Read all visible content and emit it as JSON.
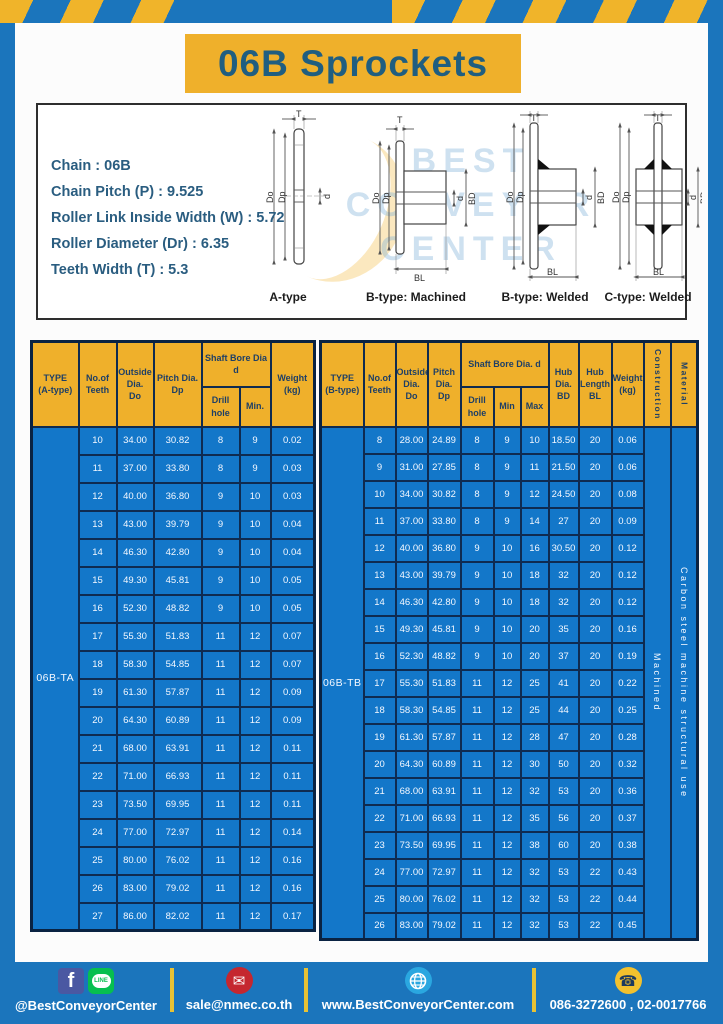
{
  "page": {
    "title": "06B Sprockets"
  },
  "colors": {
    "frame_blue": "#1b75bc",
    "accent_yellow": "#efb02b",
    "table_cell_blue": "#1377c9",
    "grid_navy": "#0f2b50",
    "title_text": "#205e80"
  },
  "specs": {
    "lines": [
      "Chain  : 06B",
      "Chain Pitch (P)  :  9.525",
      "Roller Link Inside Width (W)  :  5.72",
      "Roller Diameter (Dr)  : 6.35",
      "Teeth Width (T)  :  5.3"
    ]
  },
  "diagrams": {
    "captions": [
      "A-type",
      "B-type: Machined",
      "B-type: Welded",
      "C-type: Welded"
    ],
    "dim_labels": {
      "t": "T",
      "do": "Do",
      "dp": "Dp",
      "d": "d",
      "bd": "BD",
      "bl": "BL"
    },
    "watermark_lines": [
      "BEST",
      "CONVEYOR",
      "CENTER"
    ]
  },
  "table_a": {
    "type_label": "06B-TA",
    "headers": {
      "type": "TYPE\n(A-type)",
      "teeth": "No.of\nTeeth",
      "outside": "Outside\nDia.\nDo",
      "pitch": "Pitch Dia.\nDp",
      "shaft_bore": "Shaft Bore Dia d",
      "drill_hole": "Drill hole",
      "min": "Min.",
      "weight": "Weight\n(kg)"
    },
    "rows": [
      [
        "10",
        "34.00",
        "30.82",
        "8",
        "9",
        "0.02"
      ],
      [
        "11",
        "37.00",
        "33.80",
        "8",
        "9",
        "0.03"
      ],
      [
        "12",
        "40.00",
        "36.80",
        "9",
        "10",
        "0.03"
      ],
      [
        "13",
        "43.00",
        "39.79",
        "9",
        "10",
        "0.04"
      ],
      [
        "14",
        "46.30",
        "42.80",
        "9",
        "10",
        "0.04"
      ],
      [
        "15",
        "49.30",
        "45.81",
        "9",
        "10",
        "0.05"
      ],
      [
        "16",
        "52.30",
        "48.82",
        "9",
        "10",
        "0.05"
      ],
      [
        "17",
        "55.30",
        "51.83",
        "11",
        "12",
        "0.07"
      ],
      [
        "18",
        "58.30",
        "54.85",
        "11",
        "12",
        "0.07"
      ],
      [
        "19",
        "61.30",
        "57.87",
        "11",
        "12",
        "0.09"
      ],
      [
        "20",
        "64.30",
        "60.89",
        "11",
        "12",
        "0.09"
      ],
      [
        "21",
        "68.00",
        "63.91",
        "11",
        "12",
        "0.11"
      ],
      [
        "22",
        "71.00",
        "66.93",
        "11",
        "12",
        "0.11"
      ],
      [
        "23",
        "73.50",
        "69.95",
        "11",
        "12",
        "0.11"
      ],
      [
        "24",
        "77.00",
        "72.97",
        "11",
        "12",
        "0.14"
      ],
      [
        "25",
        "80.00",
        "76.02",
        "11",
        "12",
        "0.16"
      ],
      [
        "26",
        "83.00",
        "79.02",
        "11",
        "12",
        "0.16"
      ],
      [
        "27",
        "86.00",
        "82.02",
        "11",
        "12",
        "0.17"
      ]
    ]
  },
  "table_b": {
    "type_label": "06B-TB",
    "construction": "Machined",
    "material": "Carbon steel machine structural use",
    "headers": {
      "type": "TYPE\n(B-type)",
      "teeth": "No.of\nTeeth",
      "outside": "Outside\nDia.\nDo",
      "pitch": "Pitch\nDia.\nDp",
      "shaft_bore": "Shaft Bore Dia. d",
      "drill_hole": "Drill hole",
      "min": "Min",
      "max": "Max",
      "hub_dia": "Hub\nDia.\nBD",
      "hub_length": "Hub\nLength\nBL",
      "weight": "Weight\n(kg)",
      "construction": "Construction",
      "material": "Material"
    },
    "rows": [
      [
        "8",
        "28.00",
        "24.89",
        "8",
        "9",
        "10",
        "18.50",
        "20",
        "0.06"
      ],
      [
        "9",
        "31.00",
        "27.85",
        "8",
        "9",
        "11",
        "21.50",
        "20",
        "0.06"
      ],
      [
        "10",
        "34.00",
        "30.82",
        "8",
        "9",
        "12",
        "24.50",
        "20",
        "0.08"
      ],
      [
        "11",
        "37.00",
        "33.80",
        "8",
        "9",
        "14",
        "27",
        "20",
        "0.09"
      ],
      [
        "12",
        "40.00",
        "36.80",
        "9",
        "10",
        "16",
        "30.50",
        "20",
        "0.12"
      ],
      [
        "13",
        "43.00",
        "39.79",
        "9",
        "10",
        "18",
        "32",
        "20",
        "0.12"
      ],
      [
        "14",
        "46.30",
        "42.80",
        "9",
        "10",
        "18",
        "32",
        "20",
        "0.12"
      ],
      [
        "15",
        "49.30",
        "45.81",
        "9",
        "10",
        "20",
        "35",
        "20",
        "0.16"
      ],
      [
        "16",
        "52.30",
        "48.82",
        "9",
        "10",
        "20",
        "37",
        "20",
        "0.19"
      ],
      [
        "17",
        "55.30",
        "51.83",
        "11",
        "12",
        "25",
        "41",
        "20",
        "0.22"
      ],
      [
        "18",
        "58.30",
        "54.85",
        "11",
        "12",
        "25",
        "44",
        "20",
        "0.25"
      ],
      [
        "19",
        "61.30",
        "57.87",
        "11",
        "12",
        "28",
        "47",
        "20",
        "0.28"
      ],
      [
        "20",
        "64.30",
        "60.89",
        "11",
        "12",
        "30",
        "50",
        "20",
        "0.32"
      ],
      [
        "21",
        "68.00",
        "63.91",
        "11",
        "12",
        "32",
        "53",
        "20",
        "0.36"
      ],
      [
        "22",
        "71.00",
        "66.93",
        "11",
        "12",
        "35",
        "56",
        "20",
        "0.37"
      ],
      [
        "23",
        "73.50",
        "69.95",
        "11",
        "12",
        "38",
        "60",
        "20",
        "0.38"
      ],
      [
        "24",
        "77.00",
        "72.97",
        "11",
        "12",
        "32",
        "53",
        "22",
        "0.43"
      ],
      [
        "25",
        "80.00",
        "76.02",
        "11",
        "12",
        "32",
        "53",
        "22",
        "0.44"
      ],
      [
        "26",
        "83.00",
        "79.02",
        "11",
        "12",
        "32",
        "53",
        "22",
        "0.45"
      ]
    ]
  },
  "footer": {
    "social_handle": "@BestConveyorCenter",
    "email": "sale@nmec.co.th",
    "website": "www.BestConveyorCenter.com",
    "phones": "086-3272600 , 02-0017766",
    "line_badge": "LINE",
    "facebook_letter": "f"
  }
}
